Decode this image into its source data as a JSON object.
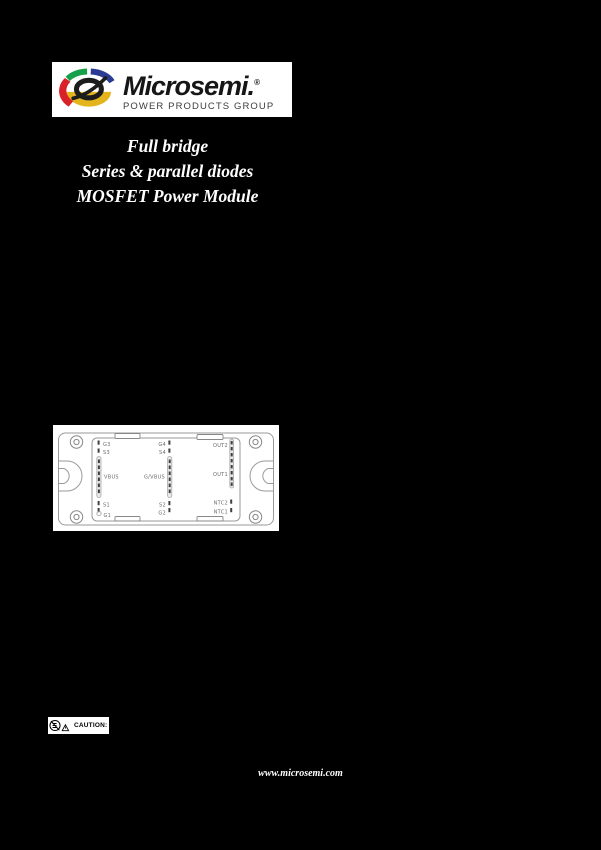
{
  "colors": {
    "page_bg": "#000000",
    "panel_bg": "#ffffff",
    "title_text": "#ffffff",
    "brand_text": "#161616",
    "brand_subtitle": "#3c3c3c",
    "diagram_line": "#9a9a9a",
    "pin_label": "#6a6a6a",
    "pin_mark": "#3f3f3f",
    "pin_strip_fill": "#e8e8e8",
    "pin_strip_stroke": "#aaaaaa",
    "logo_red": "#d92128",
    "logo_green": "#17a04b",
    "logo_blue": "#2b3a92",
    "logo_yellow": "#e3b41c",
    "logo_dark": "#1c1c1c"
  },
  "header": {
    "logo": {
      "brand": "Microsemi.",
      "registered": "®",
      "subtitle": "POWER PRODUCTS GROUP"
    }
  },
  "title": {
    "line1": "Full bridge",
    "line2": "Series & parallel diodes",
    "line3": "MOSFET Power Module"
  },
  "module_diagram": {
    "pins_left": [
      "G3",
      "S3",
      "VBUS",
      "S1",
      "G1"
    ],
    "pins_middle": [
      "G4",
      "S4",
      "G/VBUS",
      "S2",
      "G2"
    ],
    "pins_right": [
      "OUT2",
      "OUT1",
      "NTC2",
      "NTC1"
    ]
  },
  "caution": {
    "label": "CAUTION:"
  },
  "footer": {
    "url": "www.microsemi.com"
  }
}
